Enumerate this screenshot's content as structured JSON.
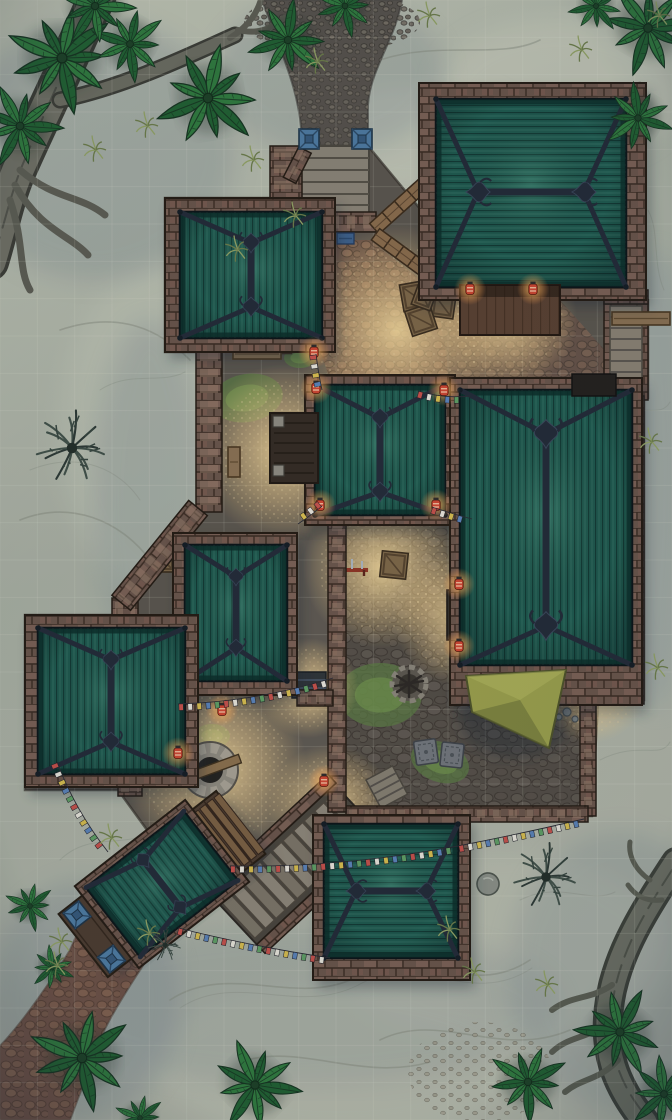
{
  "meta": {
    "type": "fantasy-battle-map",
    "subject": "jungle monastery compound at dusk",
    "grid": {
      "cols": 18,
      "rows": 30,
      "cell_px": 37.333,
      "line_color": "#eef2e2",
      "line_opacity": 0.13
    }
  },
  "palette": {
    "sand": "#aeb3a6",
    "sandLight": "#c9ccbb",
    "sandShadow": "#7d8a90",
    "swirl": "#82887a",
    "road": "#56514b",
    "roadStone": "#6f695f",
    "redPath": "#6d5044",
    "redStone": "#8f6a55",
    "court": "#5b554d",
    "courtStone": "#67605a",
    "gravel": "#c3a97e",
    "gravelHi": "#ecd6a4",
    "moss": "#5c7c43",
    "mossHi": "#74984f",
    "wall": "#6a544a",
    "wallLight": "#82675a",
    "wallDark": "#3c2d24",
    "merlon": "#977d6a",
    "roof": "#1e5a4e",
    "roofLight": "#2f7c69",
    "roofDark": "#133d36",
    "roofEdge": "#0a2d28",
    "beam": "#222a37",
    "beamHi": "#3a465a",
    "wood": "#6e543d",
    "woodLight": "#8a6c4b",
    "woodDark": "#453525",
    "deck": "#5a4030",
    "awning": "#9ba04b",
    "awningDark": "#6c7236",
    "bluecap": "#4e7ba2",
    "bluecapDark": "#1d3347",
    "lantern": "#cf4530",
    "lanternGlow": "#ffb056",
    "well": "#9b968c",
    "wellDark": "#23211e",
    "stoneStep": "#8b8476",
    "palm": "#2f7a3d",
    "palmDark": "#206030",
    "palmLine": "#16331f",
    "shrub": "#415048",
    "tuft": "#93a364"
  },
  "map": {
    "buildings": [
      {
        "id": "hall-northeast",
        "roof": "hip",
        "ridge": "horizontal"
      },
      {
        "id": "hall-northwest",
        "roof": "hip",
        "ridge": "vertical"
      },
      {
        "id": "central-pagoda",
        "roof": "hip",
        "ridge": "vertical",
        "porch": "west"
      },
      {
        "id": "great-hall-east",
        "roof": "hip",
        "ridge": "vertical",
        "awning": "south"
      },
      {
        "id": "hall-west-upper",
        "roof": "hip",
        "ridge": "vertical"
      },
      {
        "id": "hall-west-lower",
        "roof": "hip",
        "ridge": "vertical"
      },
      {
        "id": "hall-south",
        "roof": "hip",
        "ridge": "horizontal"
      },
      {
        "id": "gatehouse-southwest",
        "roof": "hip",
        "rotation_deg": -38
      }
    ],
    "lanterns": [
      [
        470,
        289
      ],
      [
        533,
        289
      ],
      [
        316,
        388
      ],
      [
        444,
        390
      ],
      [
        320,
        505
      ],
      [
        436,
        505
      ],
      [
        459,
        584
      ],
      [
        459,
        646
      ],
      [
        222,
        710
      ],
      [
        178,
        753
      ],
      [
        324,
        781
      ],
      [
        314,
        352
      ]
    ],
    "light_pools": [
      [
        398,
        330,
        105
      ],
      [
        505,
        318,
        72
      ],
      [
        285,
        452,
        88
      ],
      [
        383,
        568,
        80
      ],
      [
        215,
        768,
        92
      ],
      [
        462,
        618,
        68
      ],
      [
        330,
        806,
        62
      ],
      [
        592,
        688,
        55
      ],
      [
        308,
        688,
        50
      ]
    ],
    "moss": [
      [
        247,
        398,
        36,
        24,
        -10
      ],
      [
        350,
        452,
        22,
        14,
        15
      ],
      [
        380,
        695,
        42,
        32,
        0
      ],
      [
        440,
        762,
        30,
        20,
        20
      ],
      [
        325,
        815,
        30,
        22,
        0
      ],
      [
        570,
        662,
        20,
        30,
        0
      ],
      [
        300,
        358,
        16,
        10,
        0
      ],
      [
        212,
        736,
        18,
        12,
        0
      ],
      [
        468,
        585,
        14,
        10,
        0
      ]
    ],
    "flag_colors": [
      "#c6504a",
      "#e8e4da",
      "#d8bd4e",
      "#5b82b8",
      "#5f9e63"
    ],
    "flag_strings": [
      [
        [
          418,
          391
        ],
        [
          444,
          399
        ],
        [
          470,
          396
        ]
      ],
      [
        [
          322,
          506
        ],
        [
          310,
          516
        ],
        [
          298,
          524
        ]
      ],
      [
        [
          432,
          507
        ],
        [
          452,
          514
        ],
        [
          472,
          519
        ]
      ],
      [
        [
          178,
          704
        ],
        [
          255,
          702
        ],
        [
          333,
          678
        ]
      ],
      [
        [
          57,
          762
        ],
        [
          75,
          810
        ],
        [
          108,
          852
        ]
      ],
      [
        [
          230,
          866
        ],
        [
          340,
          868
        ],
        [
          458,
          846
        ]
      ],
      [
        [
          458,
          846
        ],
        [
          520,
          834
        ],
        [
          584,
          819
        ]
      ],
      [
        [
          178,
          928
        ],
        [
          250,
          946
        ],
        [
          330,
          958
        ]
      ],
      [
        [
          316,
          354
        ],
        [
          318,
          372
        ],
        [
          322,
          390
        ]
      ]
    ],
    "palms": [
      [
        62,
        58,
        1.1,
        0
      ],
      [
        20,
        126,
        0.85,
        40
      ],
      [
        130,
        44,
        0.75,
        120
      ],
      [
        208,
        98,
        1.05,
        80
      ],
      [
        288,
        40,
        0.8,
        200
      ],
      [
        345,
        6,
        0.62,
        0
      ],
      [
        95,
        6,
        0.8,
        160
      ],
      [
        648,
        28,
        0.95,
        30
      ],
      [
        638,
        118,
        0.7,
        300
      ],
      [
        596,
        6,
        0.55,
        90
      ],
      [
        82,
        1058,
        1.05,
        0
      ],
      [
        255,
        1085,
        0.92,
        45
      ],
      [
        528,
        1082,
        0.8,
        10
      ],
      [
        620,
        1032,
        0.9,
        220
      ],
      [
        664,
        1094,
        0.75,
        60
      ],
      [
        30,
        906,
        0.5,
        0
      ],
      [
        52,
        968,
        0.45,
        60
      ],
      [
        140,
        1118,
        0.5,
        0
      ]
    ],
    "tufts": [
      [
        148,
        126
      ],
      [
        96,
        150
      ],
      [
        254,
        160
      ],
      [
        296,
        216
      ],
      [
        238,
        250
      ],
      [
        318,
        62
      ],
      [
        430,
        16
      ],
      [
        582,
        50
      ],
      [
        150,
        934
      ],
      [
        62,
        942
      ],
      [
        58,
        966
      ],
      [
        475,
        972
      ],
      [
        548,
        985
      ],
      [
        652,
        442
      ],
      [
        658,
        668
      ],
      [
        112,
        838
      ],
      [
        450,
        930
      ],
      [
        660,
        16
      ]
    ],
    "shrubs": [
      [
        72,
        448,
        1.05
      ],
      [
        546,
        877,
        0.95
      ],
      [
        165,
        945,
        0.5
      ]
    ],
    "props": [
      {
        "name": "well-firepit",
        "x": 210,
        "y": 770
      },
      {
        "name": "campfire-ring",
        "x": 409,
        "y": 684
      },
      {
        "name": "crate",
        "x": 415,
        "y": 296,
        "r": -10,
        "s": 27
      },
      {
        "name": "crate",
        "x": 443,
        "y": 306,
        "r": 8,
        "s": 23
      },
      {
        "name": "crate",
        "x": 421,
        "y": 320,
        "r": -18,
        "s": 26
      },
      {
        "name": "crate",
        "x": 283,
        "y": 345,
        "r": 0,
        "s": 17
      },
      {
        "name": "crate",
        "x": 394,
        "y": 565,
        "r": 6,
        "s": 26
      },
      {
        "name": "crate",
        "x": 165,
        "y": 562,
        "r": 0,
        "s": 20
      },
      {
        "name": "crate",
        "x": 424,
        "y": 298,
        "r": 20,
        "s": 20
      },
      {
        "name": "metal-grate",
        "x": 301,
        "y": 341
      },
      {
        "name": "bench-h",
        "x": 233,
        "y": 349,
        "w": 48,
        "h": 10
      },
      {
        "name": "bench-h",
        "x": 612,
        "y": 312,
        "w": 58,
        "h": 13
      },
      {
        "name": "bench-v",
        "x": 228,
        "y": 447,
        "w": 12,
        "h": 30
      },
      {
        "name": "bench-dark",
        "x": 447,
        "y": 590,
        "w": 14,
        "h": 50
      },
      {
        "name": "mat",
        "x": 426,
        "y": 752,
        "r": -8
      },
      {
        "name": "mat",
        "x": 452,
        "y": 755,
        "r": 6
      },
      {
        "name": "weapon-rack",
        "x": 352,
        "y": 570
      },
      {
        "name": "boulder",
        "x": 488,
        "y": 884,
        "r": 11
      },
      {
        "name": "stone",
        "x": 567,
        "y": 712,
        "r": 4
      },
      {
        "name": "stone",
        "x": 575,
        "y": 719,
        "r": 3
      },
      {
        "name": "stone",
        "x": 559,
        "y": 717,
        "r": 3
      },
      {
        "name": "gate-mat",
        "x": 318,
        "y": 233
      },
      {
        "name": "gate-mat",
        "x": 337,
        "y": 233
      },
      {
        "name": "door-mat-blue",
        "x": 577,
        "y": 378
      }
    ]
  }
}
